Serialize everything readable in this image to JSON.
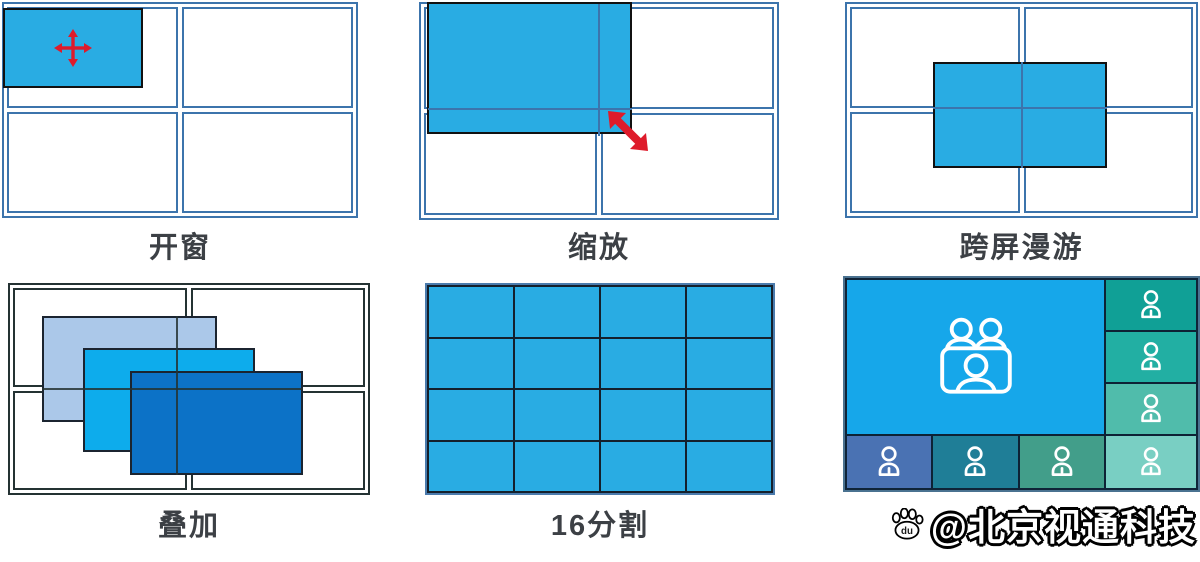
{
  "panels": [
    {
      "name": "open-window",
      "label": "开窗"
    },
    {
      "name": "zoom-scale",
      "label": "缩放"
    },
    {
      "name": "cross-screen-roam",
      "label": "跨屏漫游"
    },
    {
      "name": "overlay-stack",
      "label": "叠加"
    },
    {
      "name": "split-16",
      "label": "16分割"
    },
    {
      "name": "video-conference",
      "label": ""
    }
  ],
  "watermark": {
    "text": "@北京视通科技",
    "icon": "baidu-paw-icon",
    "icon_letters": "du"
  },
  "icons": [
    "move-arrow-icon",
    "resize-arrow-icon",
    "meeting-group-icon",
    "person-icon",
    "baidu-paw-icon"
  ],
  "colors": {
    "window_cyan": "#29ACE3",
    "wall_grid_blue": "#3C74AC",
    "wall_grid_dark": "#243233",
    "window_border": "#111111",
    "arrow_red": "#DE1B2B",
    "label_text": "#3C4045",
    "split16_cell": "#29ACE3",
    "split16_line": "#14202C",
    "split16_outer": "#4A7BAD",
    "overlay_back": "#ABC8E9",
    "overlay_mid": "#0DACEC",
    "overlay_front": "#0C72C7",
    "conf_line": "#0D2235",
    "conf_big": "#16A7EA",
    "conf_right_col": [
      "#10A096",
      "#22AFA3",
      "#50BCAB",
      "#79CFC3"
    ],
    "conf_bottom_row": [
      "#4A72B3",
      "#1F7E97",
      "#429E8A"
    ],
    "watermark_fill": "#FFFFFF",
    "watermark_outline": "#000000"
  }
}
